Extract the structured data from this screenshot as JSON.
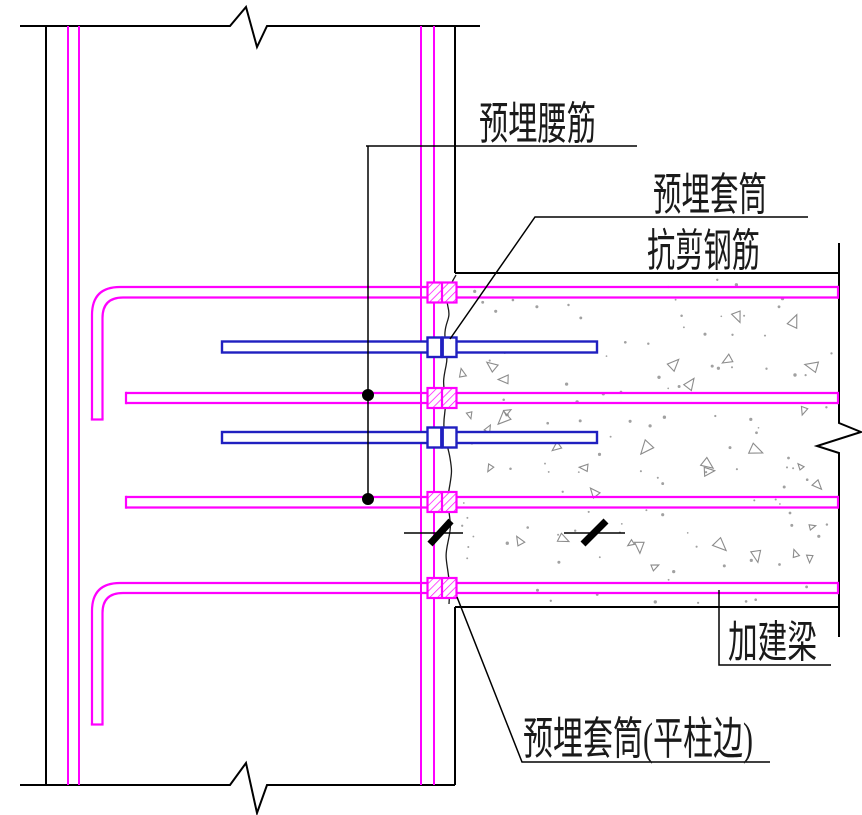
{
  "drawing": {
    "description": "embedded-sleeve beam-to-column connection detail",
    "labels": {
      "waist_bar": "预埋腰筋",
      "embedded_sleeve": "预埋套筒",
      "shear_rebar": "抗剪钢筋",
      "added_beam": "加建梁",
      "embedded_sleeve_flush": "预埋套筒(平柱边)"
    },
    "colors": {
      "rebar_magenta": "#FF00FF",
      "shear_blue": "#2020C0",
      "line_black": "#000000",
      "stipple_gray": "#8C8C8C",
      "background": "#FFFFFF"
    }
  }
}
